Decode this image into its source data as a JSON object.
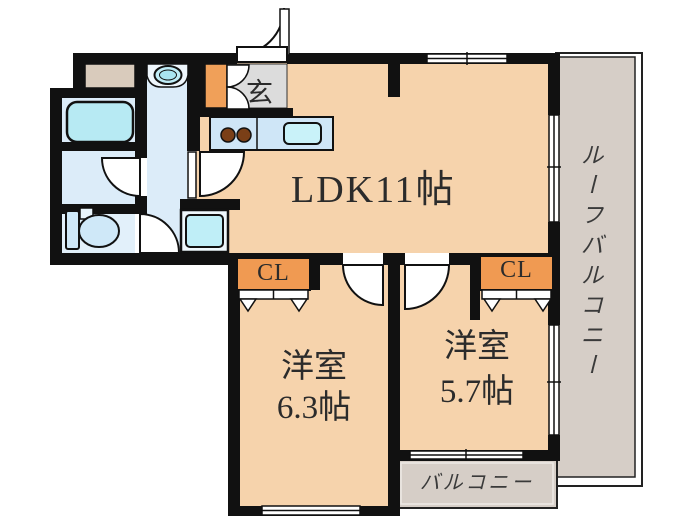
{
  "floorplan": {
    "type": "japanese-apartment-floorplan",
    "labels": {
      "ldk": "LDK11帖",
      "bedroom1_line1": "洋室",
      "bedroom1_line2": "6.3帖",
      "bedroom2_line1": "洋室",
      "bedroom2_line2": "5.7帖",
      "closet1": "CL",
      "closet2": "CL",
      "entrance": "玄",
      "balcony": "バルコニー",
      "roof_balcony": "ルーフバルコニー"
    },
    "colors": {
      "wall": "#111111",
      "room_floor_peach": "#f6d3ac",
      "closet_orange": "#f09a52",
      "wet_area_blue": "#dcecf9",
      "fixture_cyan": "#b7eaf3",
      "kitchen_counter_blue": "#cfe6f7",
      "burner_brown": "#7a3f17",
      "entrance_gray": "#dcdcdc",
      "balcony_gray": "#d6cec7",
      "shaft_tan": "#d9cbbc",
      "text": "#2b2b2b"
    },
    "fixture_icons": [
      "bathtub-icon",
      "washbasin-icon",
      "toilet-icon",
      "washing-machine-pan-icon",
      "stove-burners-icon",
      "kitchen-sink-icon",
      "door-swing-arc-icon",
      "sliding-window-icon",
      "folding-closet-door-icon"
    ]
  }
}
